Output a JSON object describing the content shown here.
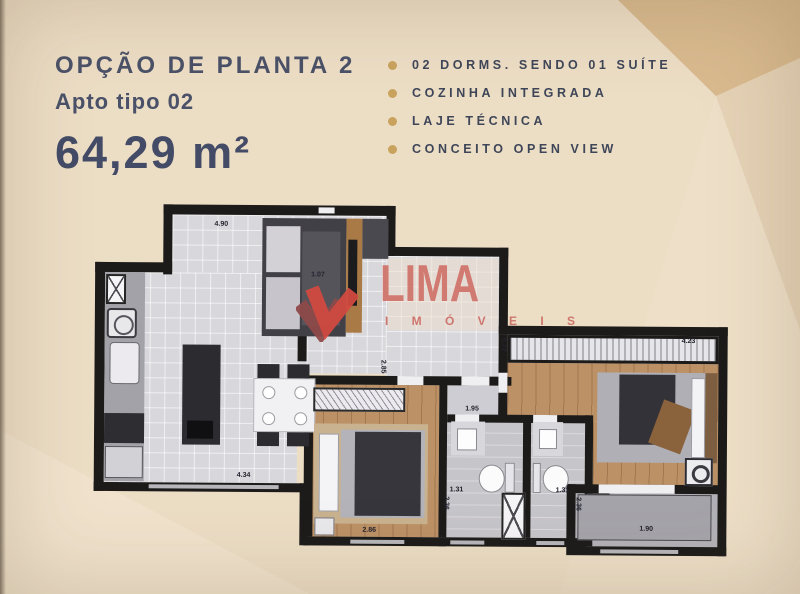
{
  "header": {
    "title": "OPÇÃO DE PLANTA 2",
    "subtitle": "Apto tipo 02",
    "area": "64,29 m²"
  },
  "features": {
    "items": [
      {
        "label": "02 DORMS. SENDO 01 SUÍTE"
      },
      {
        "label": "COZINHA INTEGRADA"
      },
      {
        "label": "LAJE TÉCNICA"
      },
      {
        "label": "CONCEITO OPEN VIEW"
      }
    ]
  },
  "watermark": {
    "name": "LIMA",
    "tagline": "I M Ó V E I S",
    "icon": "check-ribbon-icon"
  },
  "floorplan": {
    "dimensions": [
      {
        "value": "4.90"
      },
      {
        "value": "1.07"
      },
      {
        "value": "3.51"
      },
      {
        "value": "4.34"
      },
      {
        "value": "2.86"
      },
      {
        "value": "1.95"
      },
      {
        "value": "1.31"
      },
      {
        "value": "1.31"
      },
      {
        "value": "2.36"
      },
      {
        "value": "2.36"
      },
      {
        "value": "5.72"
      },
      {
        "value": "4.23"
      },
      {
        "value": "1.90"
      },
      {
        "value": "2.85"
      }
    ]
  },
  "colors": {
    "background": "#ecddc5",
    "facet_gold": "#d9ba8f",
    "title_navy": "#4a5168",
    "bullet_gold": "#c9a25e",
    "logo_red": "#d0746b",
    "wall_black": "#1c1b1a",
    "wood_floor": "#bd9166"
  }
}
